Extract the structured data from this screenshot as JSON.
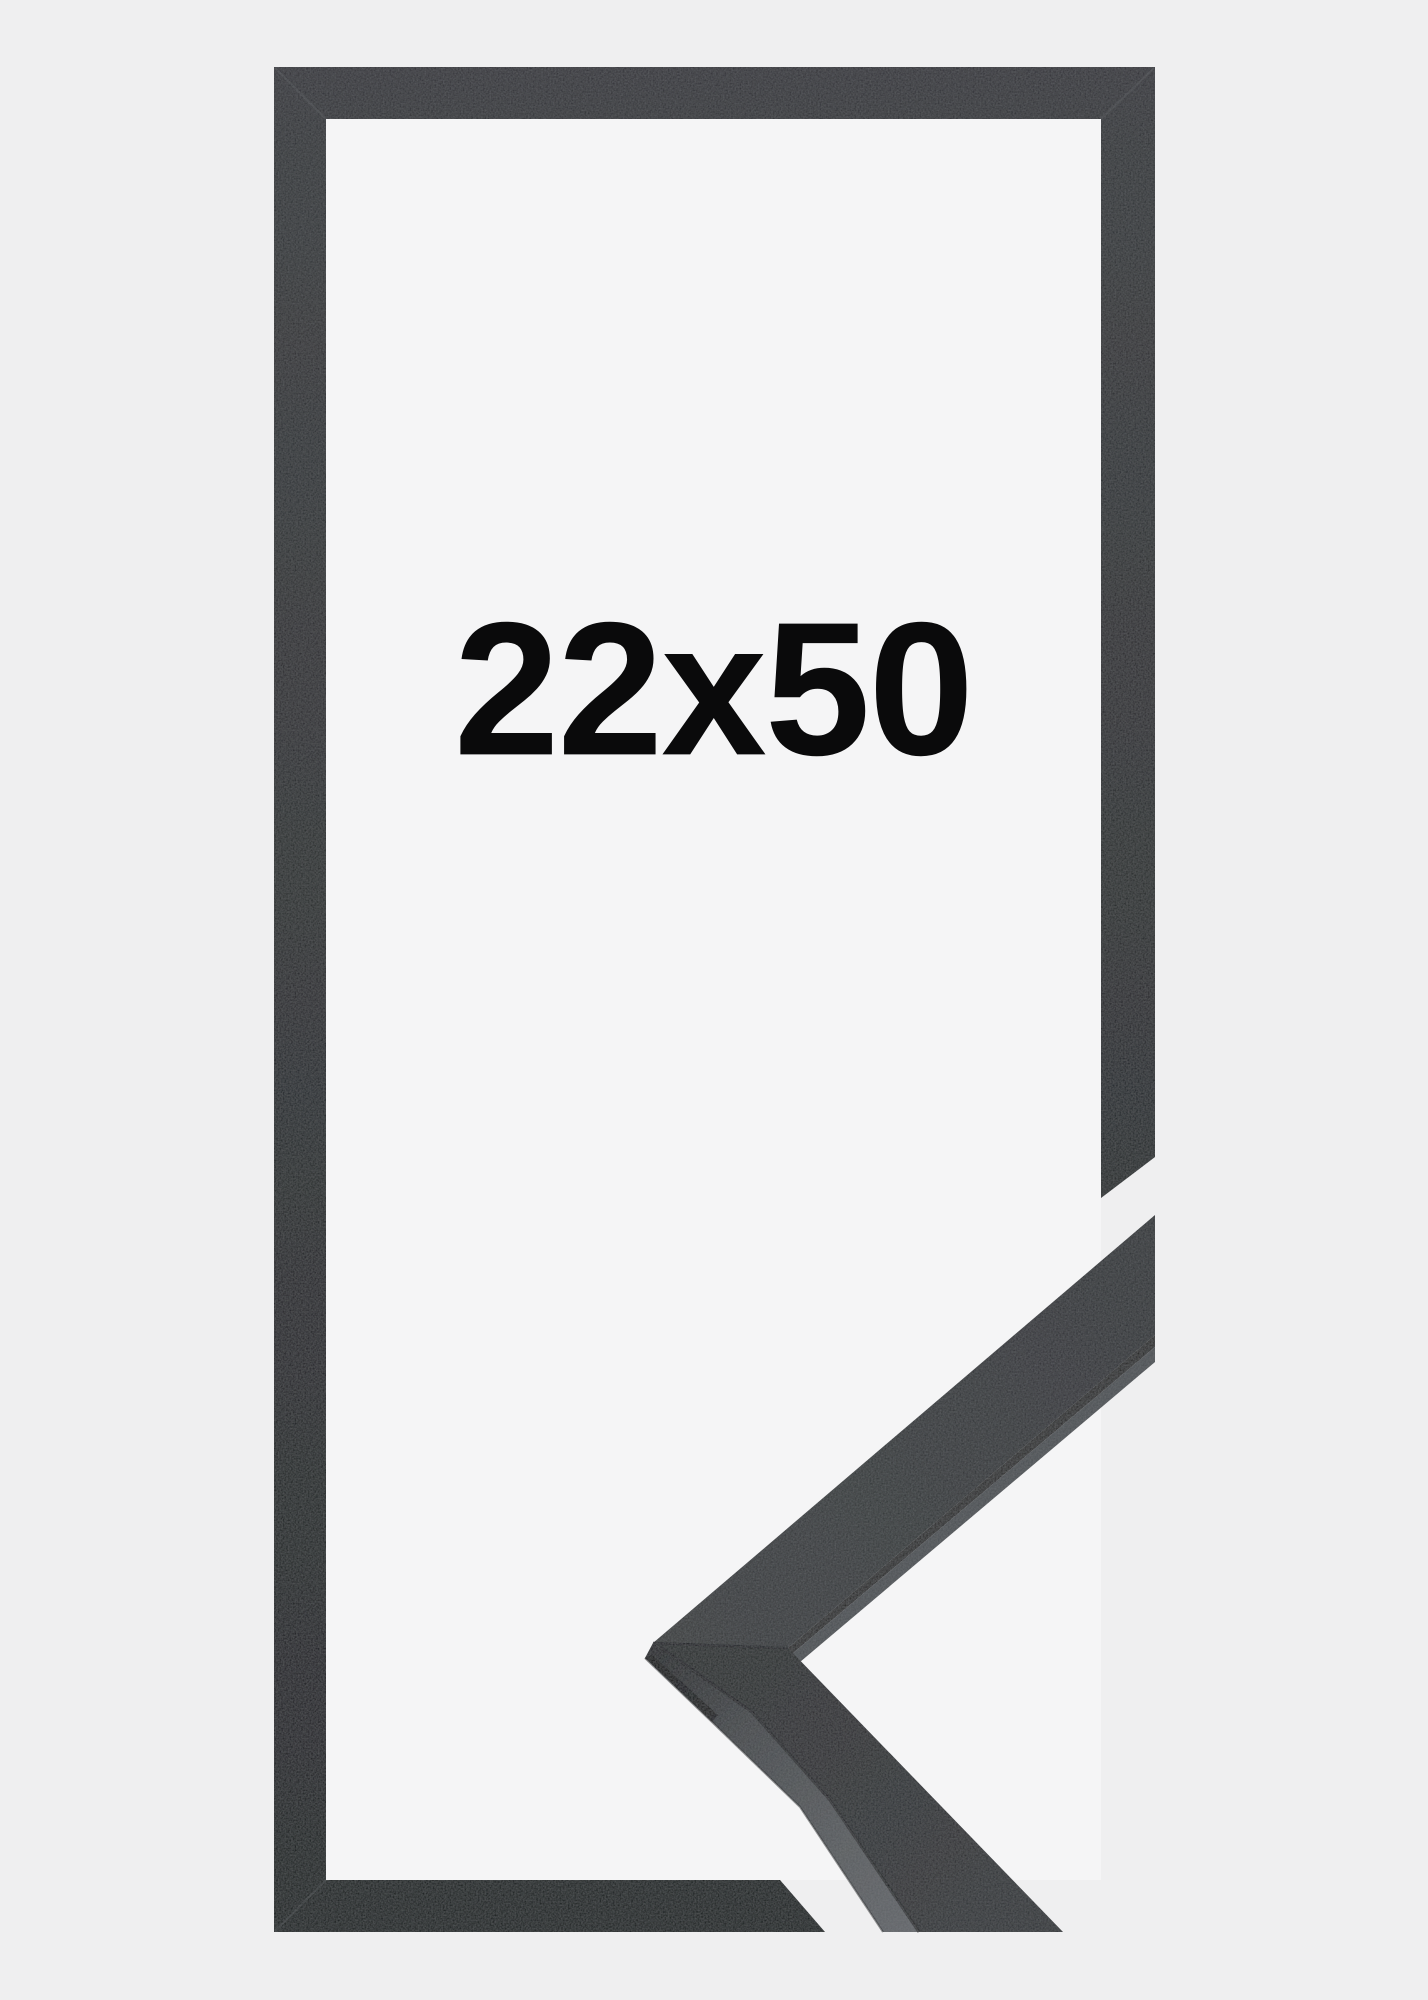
{
  "product": {
    "size_label": "22x50"
  },
  "image_parts": {
    "frame_outline": "empty picture frame outline, portrait orientation",
    "corner_profile": "3D photo of mitered frame corner molding, cutaway at lower right"
  },
  "colors": {
    "bg-outer": "#efeff0",
    "bg-inner": "#f5f5f6",
    "frame-dark-top": "#37393c",
    "frame-dark-bottom": "#232527",
    "molding-face": "#333639",
    "molding-side-highlight": "#63666a",
    "seam-shadow": "#17181a",
    "text-color": "#0a0a0b"
  }
}
